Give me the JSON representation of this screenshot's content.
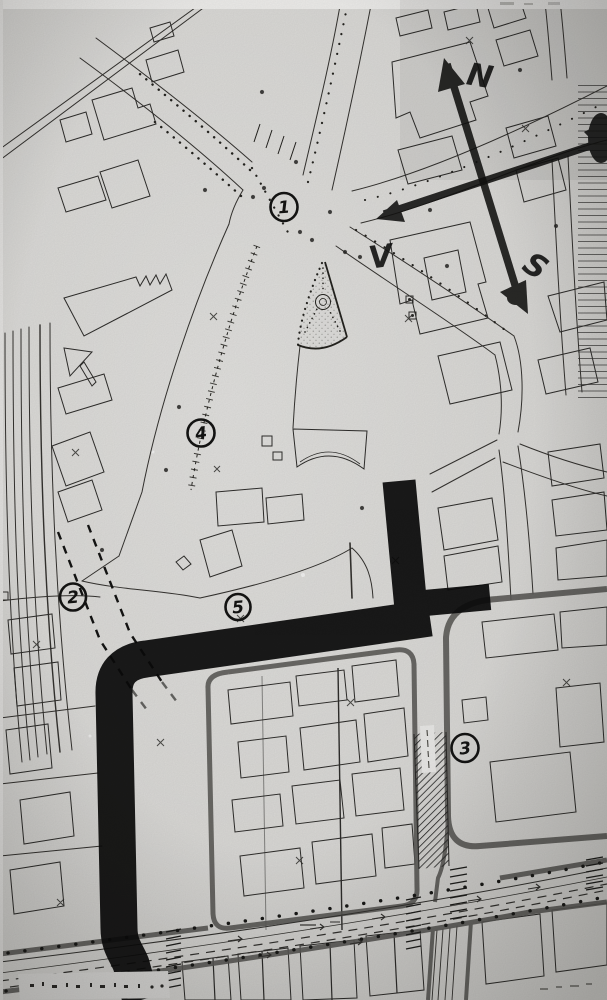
{
  "compass": {
    "north": "N",
    "west": "V",
    "south": "S"
  },
  "markers": [
    {
      "label": "1"
    },
    {
      "label": "2"
    },
    {
      "label": "3"
    },
    {
      "label": "4"
    },
    {
      "label": "5"
    }
  ],
  "colors": {
    "paper": "#d7d6d3",
    "ink": "#2e2d2b",
    "marker_black": "#0b0b0b",
    "street_casing": "#5c5b58",
    "highlight_white": "#e9e8e6"
  }
}
